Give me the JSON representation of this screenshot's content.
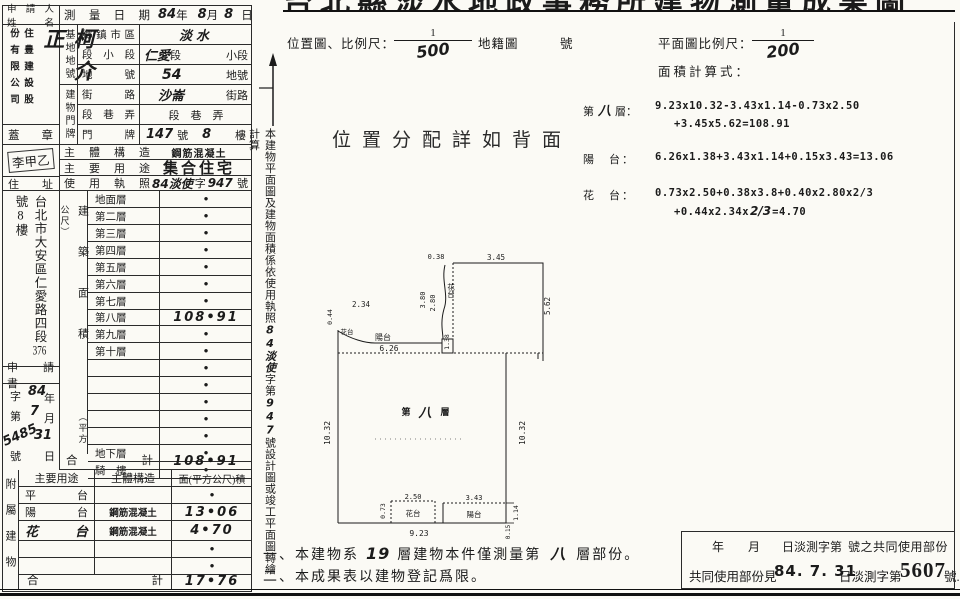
{
  "sheet_title": "台北縣淡水地政事務所建物測量成果圖",
  "applicant": {
    "label_l1": "申請人",
    "label_l2": "姓　名",
    "company_left": "份有限公司",
    "company_right": "住豊建設股",
    "name": "柯介正",
    "seal_label": "蓋　章",
    "seal_stamp": "李甲乙",
    "address_label": "住　址",
    "address_pre": "台北市大安區仁愛路四段",
    "address_no": "376",
    "address_mid": "號",
    "address_no2": "8",
    "address_post": "樓"
  },
  "survey_date": {
    "label": "測量日期",
    "year": "84",
    "year_u": "年",
    "month": "8",
    "month_u": "月",
    "day": "8",
    "day_u": "日"
  },
  "site": {
    "group": "基地地號",
    "r1_label": "鄉鎮市區",
    "r1_value": "淡水",
    "r2_label": "段小段",
    "r2_hw": "仁愛",
    "r2_mid": "段",
    "r2_suffix": "小段",
    "r3_label": "地　號",
    "r3_value": "54",
    "r3_suffix": "地號"
  },
  "door": {
    "group": "建物門牌",
    "r1_label": "街　路",
    "r1_value": "沙崙",
    "r1_suffix": "街路",
    "r2_label": "段巷弄",
    "r2_value": "段　巷　弄",
    "r3_label": "門　牌",
    "r3_no": "147",
    "r3_u1": "號",
    "r3_no2": "8",
    "r3_u2": "樓"
  },
  "structure_row": {
    "label": "主體構造",
    "value": "鋼筋混凝土"
  },
  "usage_row": {
    "label": "主要用途",
    "value": "集合住宅"
  },
  "license_row": {
    "label": "使用執照",
    "hw1": "84淡使",
    "mid": "字",
    "hw2": "947",
    "suffix": "號"
  },
  "floor_table": {
    "group": "建築面積",
    "unit": "（平方公尺）",
    "rows": [
      {
        "label": "地面層",
        "value": "•"
      },
      {
        "label": "第二層",
        "value": "•"
      },
      {
        "label": "第三層",
        "value": "•"
      },
      {
        "label": "第四層",
        "value": "•"
      },
      {
        "label": "第五層",
        "value": "•"
      },
      {
        "label": "第六層",
        "value": "•"
      },
      {
        "label": "第七層",
        "value": "•"
      },
      {
        "label": "第八層",
        "value": "108•91"
      },
      {
        "label": "第九層",
        "value": "•"
      },
      {
        "label": "第十層",
        "value": "•"
      },
      {
        "label": "",
        "value": "•"
      },
      {
        "label": "",
        "value": "•"
      },
      {
        "label": "",
        "value": "•"
      },
      {
        "label": "",
        "value": "•"
      },
      {
        "label": "",
        "value": "•"
      },
      {
        "label": "地下層",
        "value": "•"
      },
      {
        "label": "騎　樓",
        "value": "•"
      }
    ],
    "total_label": "合　　計",
    "total_value": "108•91"
  },
  "application": {
    "header": "申　請　書",
    "r1_p": "字",
    "r1_hw": "84",
    "r1_s": "年",
    "r2_p": "第",
    "r2_hw": "7",
    "r2_s": "月",
    "r3_hw1": "5485",
    "r3_hw2": "31",
    "r4_p": "號",
    "r4_s": "日"
  },
  "annex_table": {
    "side": "附屬建物",
    "h1": "主要用途",
    "h2": "主體構造",
    "h3": "面(平方公尺)積",
    "rows": [
      {
        "use": "平　台",
        "structure": "",
        "area": "•"
      },
      {
        "use": "陽　台",
        "structure": "鋼筋混凝土",
        "area": "13•06"
      },
      {
        "use": "花　台",
        "structure": "鋼筋混凝土",
        "area": "4•70"
      },
      {
        "use": "",
        "structure": "",
        "area": "•"
      },
      {
        "use": "",
        "structure": "",
        "area": "•"
      }
    ],
    "total_label": "合　　計",
    "total_value": "17•76"
  },
  "side_note": {
    "pre": "本建物平面圖及建物面積係依使用執照",
    "hw1": "84淡使",
    "mid": "字第",
    "hw2": "947",
    "post": "號設計圖或竣工平面圖轉繪計算"
  },
  "location_row": {
    "label": "位置圖、比例尺：",
    "num": "1",
    "den": "500",
    "map": "地籍圖",
    "no": "號"
  },
  "plan_scale": {
    "label": "平面圖比例尺：",
    "num": "1",
    "den": "200"
  },
  "calc": {
    "label": "面積計算式：",
    "f1_pre": "第",
    "f1_hw": "八",
    "f1_post": "層：",
    "f1_line1": "9.23x10.32-3.43x1.14-0.73x2.50",
    "f1_line2": "+3.45x5.62=108.91",
    "f2_name": "陽　台：",
    "f2_line1": "6.26x1.38+3.43x1.14+0.15x3.43=13.06",
    "f3_name": "花　台：",
    "f3_line1": "0.73x2.50+0.38x3.8+0.40x2.80x2/3",
    "f3_line2a": "+0.44x2.34x",
    "f3_hw": "2/3",
    "f3_line2b": "=4.70"
  },
  "center_note": "位置分配詳如背面",
  "plan": {
    "floor_pre": "第",
    "floor_hw": "八",
    "floor_post": "層",
    "flower": "花台",
    "balcony": "陽台",
    "d038": "0.38",
    "d345": "3.45",
    "d380": "3.80",
    "d280": "2.80",
    "d562": "5.62",
    "d044": "0.44",
    "d234": "2.34",
    "d138": "1.38",
    "d626": "6.26",
    "d1032": "10.32",
    "d923": "9.23",
    "d073": "0.73",
    "d250": "2.50",
    "d343": "3.43",
    "d114": "1.14",
    "d015": "0.15"
  },
  "notes": {
    "n1a": "一、本建物系",
    "n1_hw": "19",
    "n1b": "層建物本件僅測量第",
    "n1_hw2": "八",
    "n1c": "層部份。",
    "n2": "二、本成果表以建物登記爲限。"
  },
  "common": {
    "l1a": "年",
    "l1b": "月",
    "l1c": "日淡測字第",
    "l1d": "號之共同使用部份",
    "l2a": "共同使用部份見",
    "stamp_date": "84. 7. 31",
    "l2b": "日淡測字第",
    "stamp_no": "5607",
    "l2c": "號."
  }
}
